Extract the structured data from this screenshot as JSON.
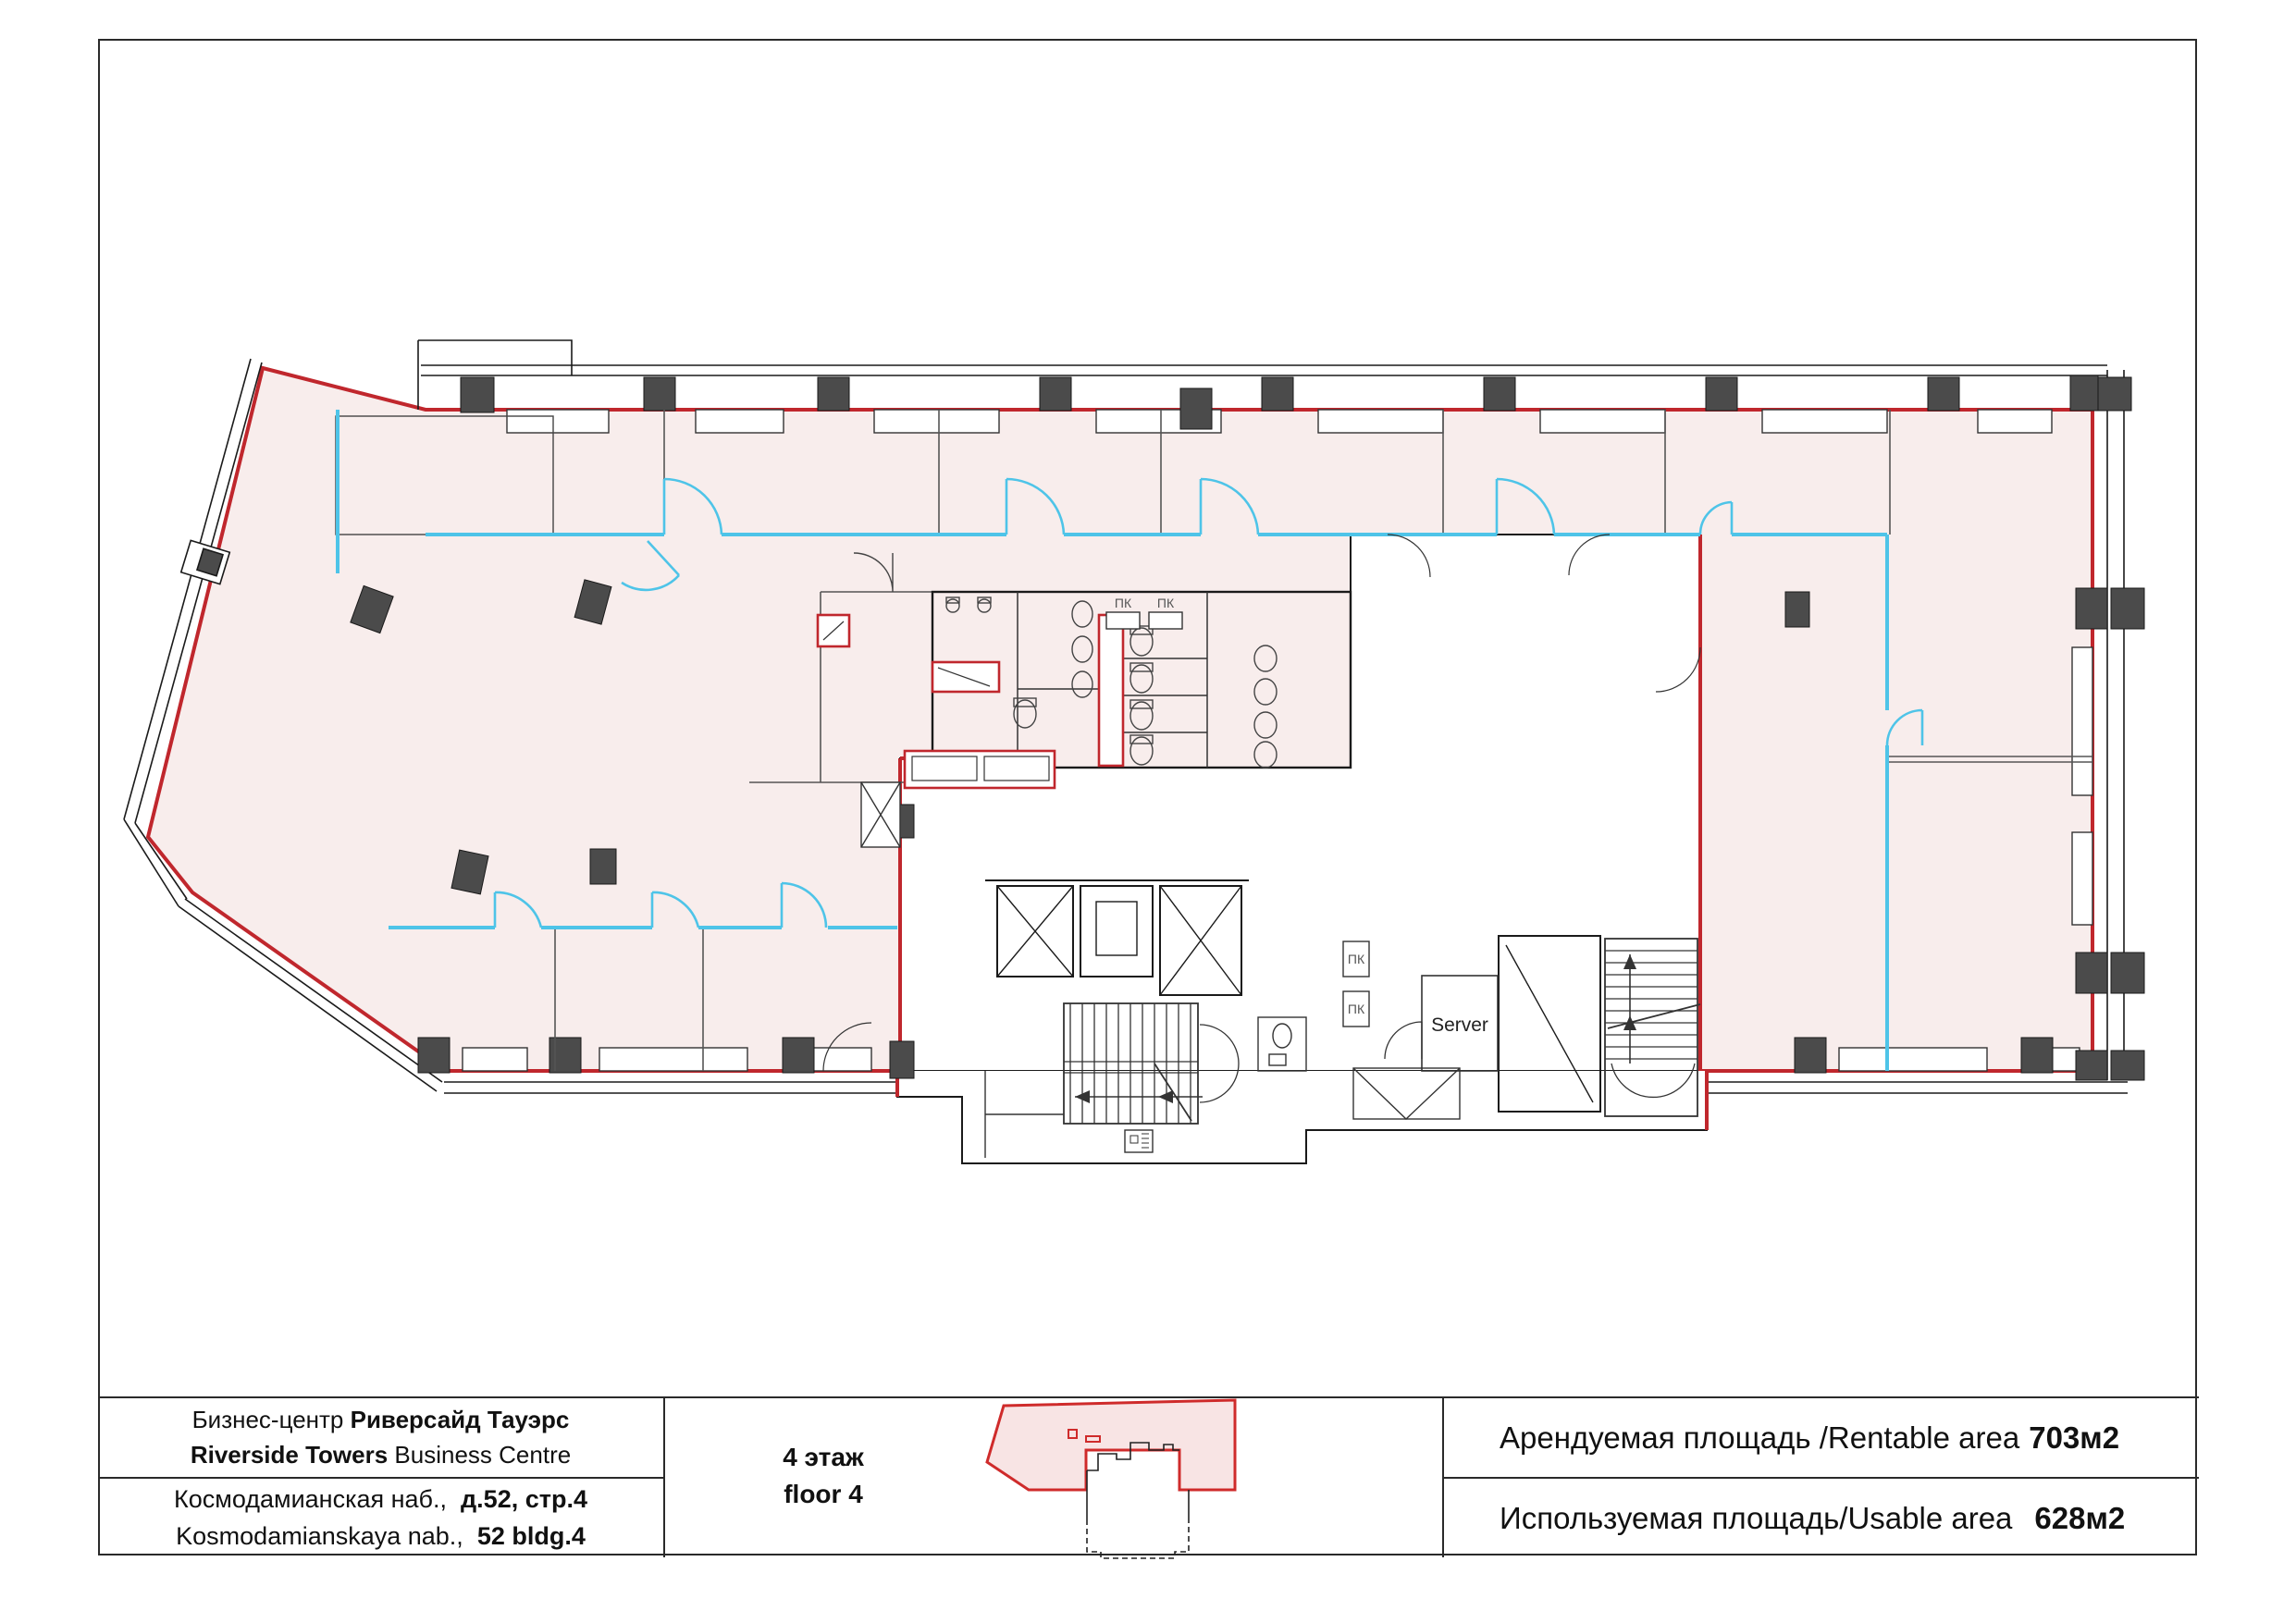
{
  "colors": {
    "rentable_fill": "#f8edec",
    "boundary_red": "#c0272d",
    "partition_cyan": "#4ec4e8",
    "column_gray": "#4b4b4b",
    "wall_black": "#1a1a1a"
  },
  "plan": {
    "server_label": "Server",
    "fire_cabinet_label": "ПК"
  },
  "title_block": {
    "company": {
      "ru_prefix": "Бизнес-центр ",
      "ru_bold": "Риверсайд Тауэрс",
      "en_bold": "Riverside Towers",
      "en_suffix": " Business Centre"
    },
    "address": {
      "ru_prefix": "Космодамианская наб.,  ",
      "ru_bold": "д.52, стр.4",
      "en_prefix": "Kosmodamianskaya nab.,  ",
      "en_bold": "52 bldg.4"
    },
    "floor": {
      "ru": "4 этаж",
      "en": "floor 4"
    },
    "rentable": {
      "label": "Арендуемая площадь /Rentable area",
      "value": "703м2"
    },
    "usable": {
      "label": "Используемая площадь/Usable area",
      "value": "628м2"
    }
  }
}
